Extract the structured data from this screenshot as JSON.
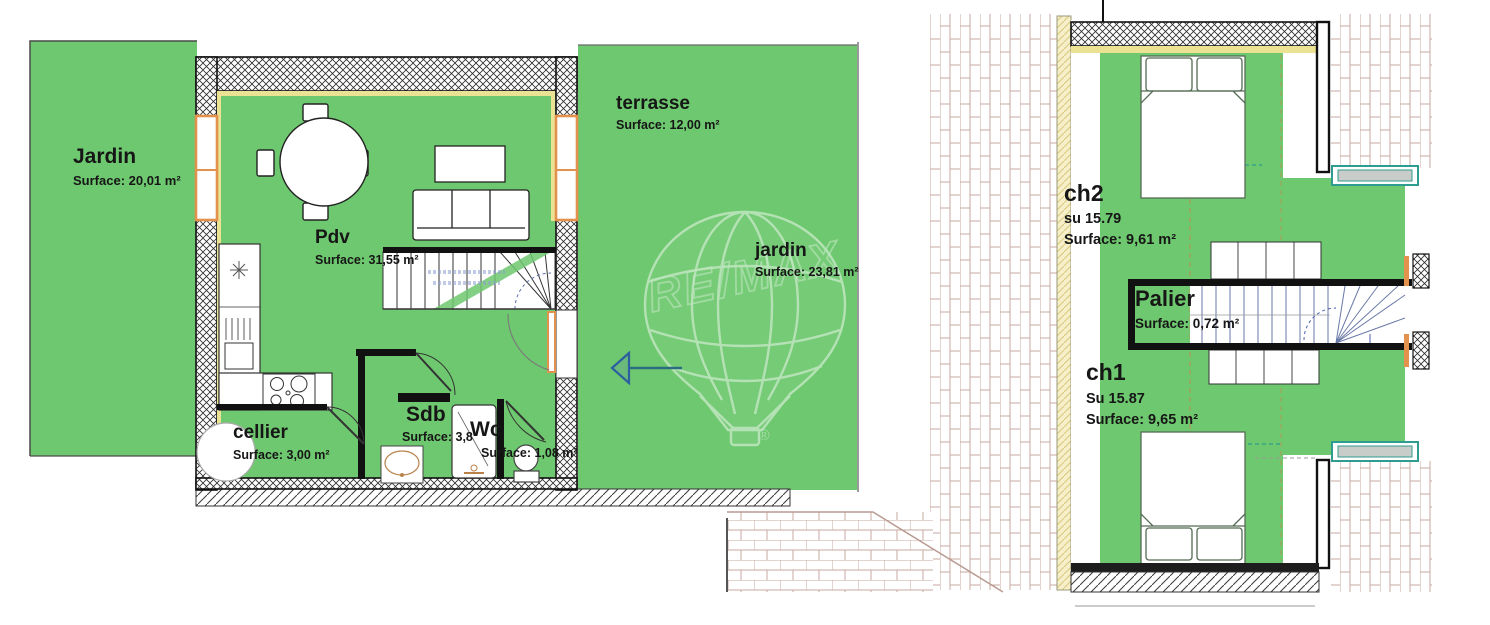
{
  "watermark": {
    "brand": "RE/MAX",
    "registered": "®"
  },
  "ground_floor": {
    "jardin_left": {
      "name": "Jardin",
      "surface": "Surface: 20,01 m²"
    },
    "terrasse": {
      "name": "terrasse",
      "surface": "Surface: 12,00 m²"
    },
    "pdv": {
      "name": "Pdv",
      "surface": "Surface: 31,55 m²"
    },
    "jardin_right": {
      "name": "jardin",
      "surface": "Surface: 23,81 m²"
    },
    "cellier": {
      "name": "cellier",
      "surface": "Surface: 3,00 m²"
    },
    "sdb": {
      "name": "Sdb",
      "surface": "Surface: 3,8"
    },
    "wc": {
      "name": "Wc",
      "surface": "Surface: 1,08 m²"
    }
  },
  "upper_floor": {
    "ch2": {
      "name": "ch2",
      "su": "su 15.79",
      "surface": "Surface: 9,61 m²"
    },
    "palier": {
      "name": "Palier",
      "surface": "Surface: 0,72 m²"
    },
    "ch1": {
      "name": "ch1",
      "su": "Su 15.87",
      "surface": "Surface: 9,65 m²"
    }
  },
  "colors": {
    "grass_green": "#6ec86f",
    "wall_black": "#1a1a1a",
    "window_orange": "#e2924d",
    "lining_yellow": "#ece294",
    "brick_line": "#c8aaa0",
    "velux_teal": "#2e9c8e",
    "stair_note_blue": "#5a6fae",
    "arrow_blue": "#2b5f9e"
  }
}
